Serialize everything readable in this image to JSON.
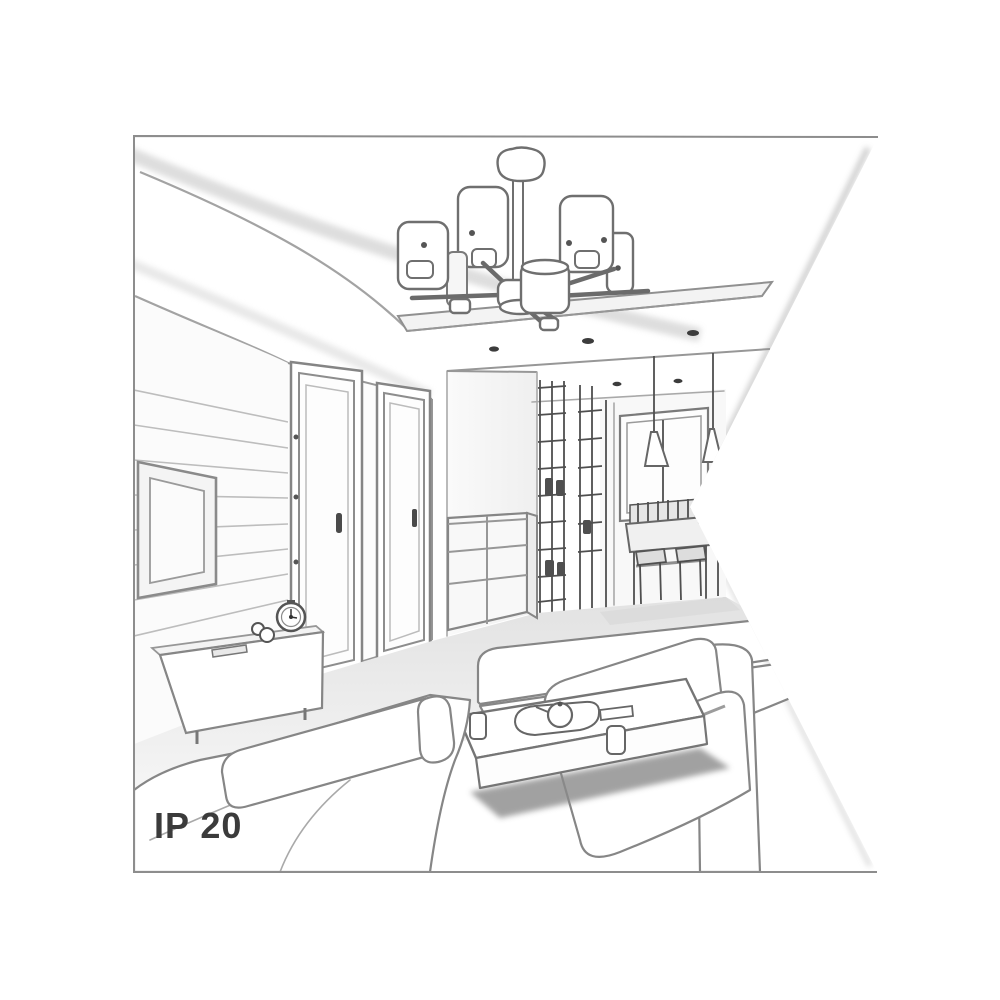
{
  "page": {
    "background_color": "#ffffff",
    "label": {
      "text": "IP 20"
    },
    "colors": {
      "frame_border": "#8d8d8d",
      "line_dark": "#4f4f4f",
      "line_medium": "#868686",
      "line_light": "#bdbdbd",
      "fill_white": "#ffffff",
      "fill_light": "#f2f2f2",
      "fill_shadow": "#8a8a8a",
      "text_color": "#3b3b3b"
    },
    "scene": {
      "type": "grayscale interior perspective sketch",
      "subject": "six-shade ceiling chandelier in a living room",
      "objects": [
        "ceiling cove",
        "suspended ceiling panel",
        "recessed spotlights",
        "chandelier with cylindrical shades",
        "tv wall",
        "tv",
        "tv sideboard",
        "alarm clock",
        "figurine",
        "interior door",
        "interior door",
        "chest of drawers",
        "shelving partition",
        "hallway window",
        "pendant lamps",
        "dining table",
        "dining chairs",
        "sofa",
        "sofa",
        "coffee table",
        "tray with teapot",
        "cups"
      ]
    }
  }
}
